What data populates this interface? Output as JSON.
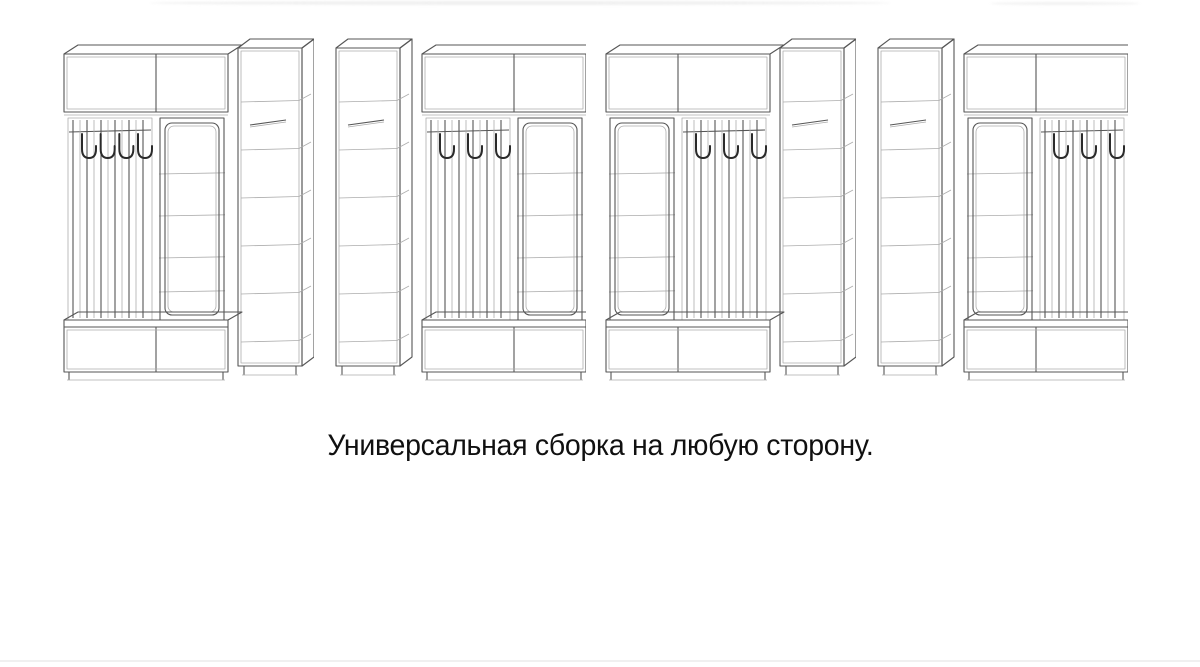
{
  "page": {
    "background_color": "#ffffff",
    "line_color": "#4d4d4d",
    "caption_color": "#101010"
  },
  "caption": {
    "text": "Универсальная сборка на любую сторону."
  },
  "diagram_data": {
    "type": "diagram",
    "figure_count": 4,
    "subject": "hallway wardrobe wireframe drawing shown in four assembly orientations",
    "variants": [
      {
        "position": 1,
        "columns": [
          "hooks",
          "mirror",
          "cabinet"
        ],
        "hook_count": 4
      },
      {
        "position": 2,
        "columns": [
          "cabinet",
          "hooks",
          "mirror"
        ],
        "hook_count": 3
      },
      {
        "position": 3,
        "columns": [
          "mirror",
          "hooks",
          "cabinet"
        ],
        "hook_count": 3
      },
      {
        "position": 4,
        "columns": [
          "cabinet",
          "mirror",
          "hooks"
        ],
        "hook_count": 3
      }
    ]
  }
}
